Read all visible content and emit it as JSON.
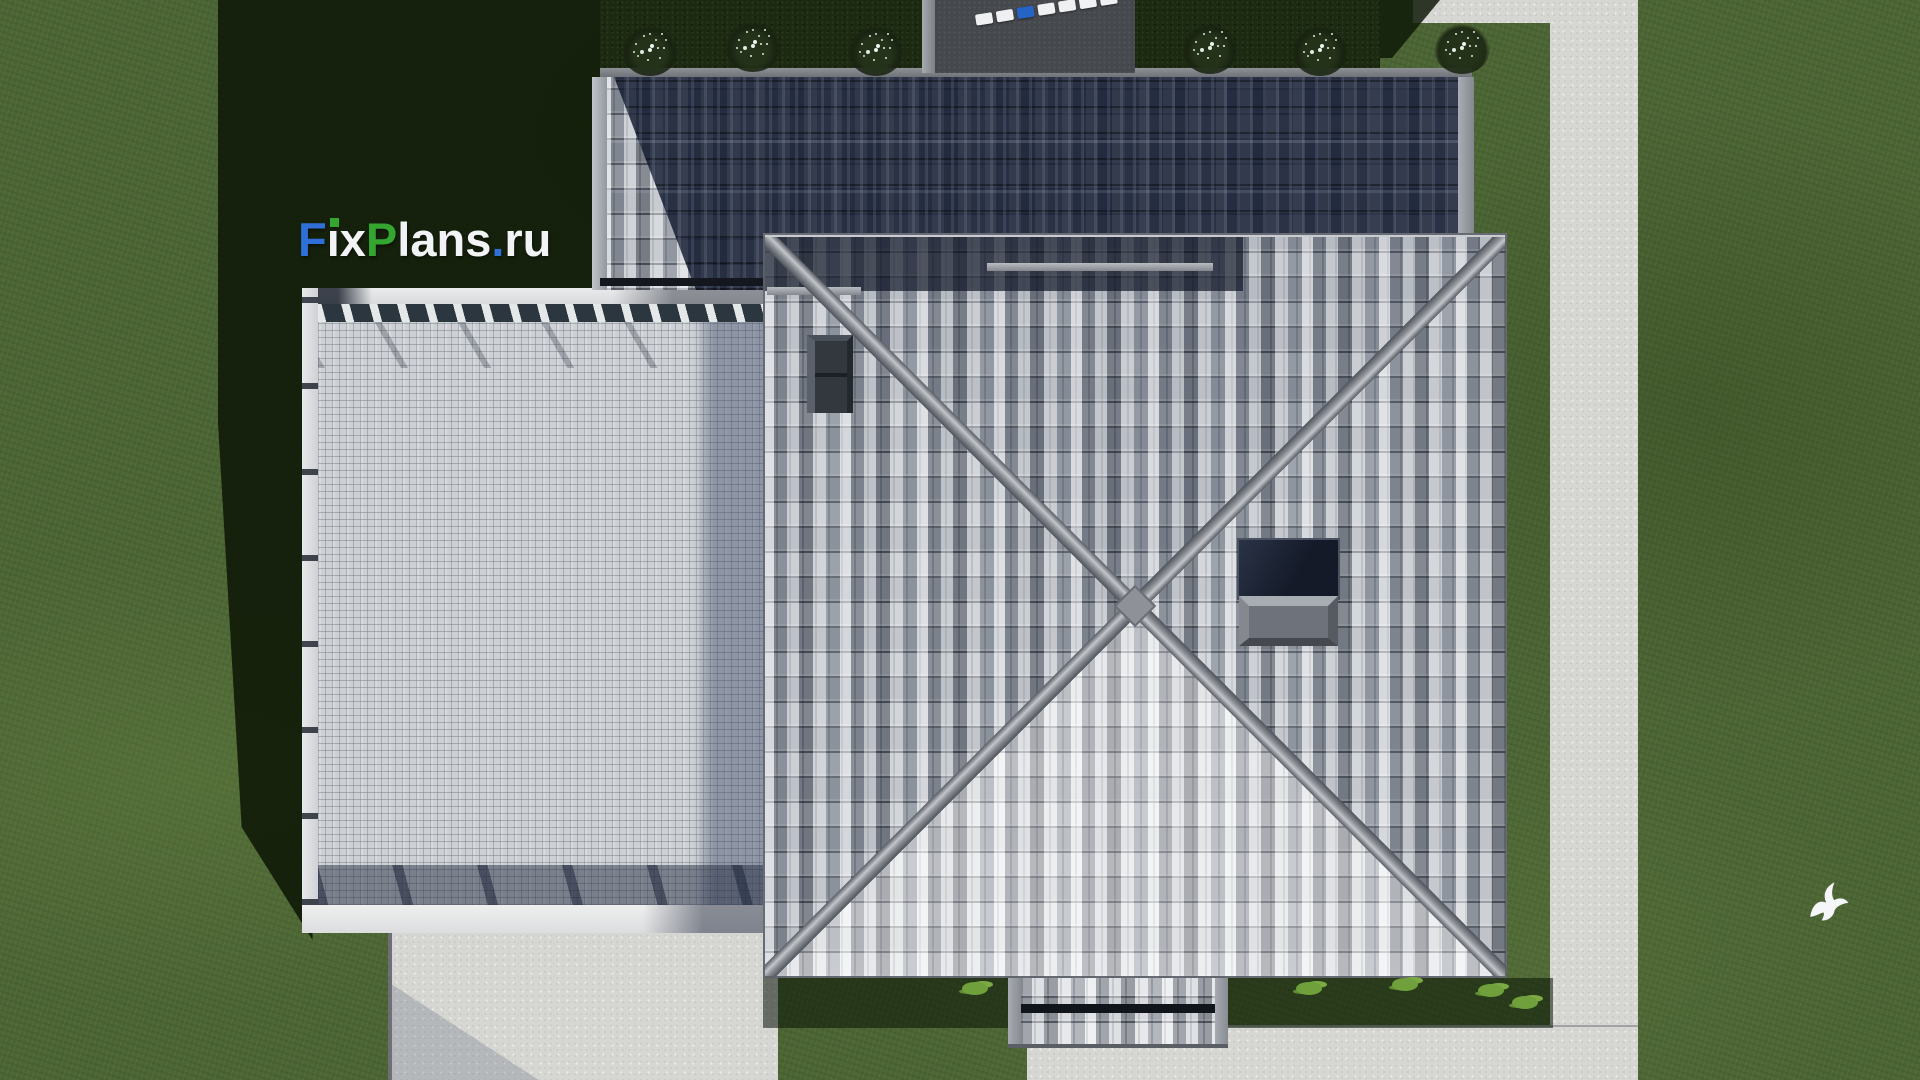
{
  "watermark": {
    "text": "FixPlans.ru",
    "segments": [
      {
        "text": "F",
        "color": "#2e6fd8"
      },
      {
        "text": "i",
        "color": "#f2f3f5",
        "dot_color": "#34a52f"
      },
      {
        "text": "x",
        "color": "#f2f3f5"
      },
      {
        "text": "P",
        "color": "#34a52f"
      },
      {
        "text": "lans",
        "color": "#f2f3f5"
      },
      {
        "text": ".",
        "color": "#2e6fd8"
      },
      {
        "text": "ru",
        "color": "#f2f3f5"
      }
    ]
  },
  "palette": {
    "grass": "#4c6534",
    "grass_shadow": "#0f1a08",
    "hedge": "#1c2a11",
    "concrete": "#d6d6d3",
    "terrace_paving": "#cdd0d4",
    "walkway": "#45484d",
    "roof_tile_light": "#e8eaed",
    "roof_tile_dark": "#4a515f",
    "roof_navy": "#1d2435",
    "ridge_gray": "#91969c",
    "gate_blue": "#2563c4",
    "bush_flowers": "#e4ebe4",
    "bird": "#f4f6f7"
  },
  "scene": {
    "type": "3d-architectural-render",
    "view": "top-down aerial",
    "elements": [
      "lawn",
      "hip-roof-house",
      "garage-roof",
      "terrace",
      "concrete-pads",
      "sidewalk",
      "hedges",
      "flowering-bushes",
      "chimney",
      "skylight",
      "porch-roof",
      "entrance-gate",
      "flying-bird",
      "house-shadow"
    ]
  }
}
